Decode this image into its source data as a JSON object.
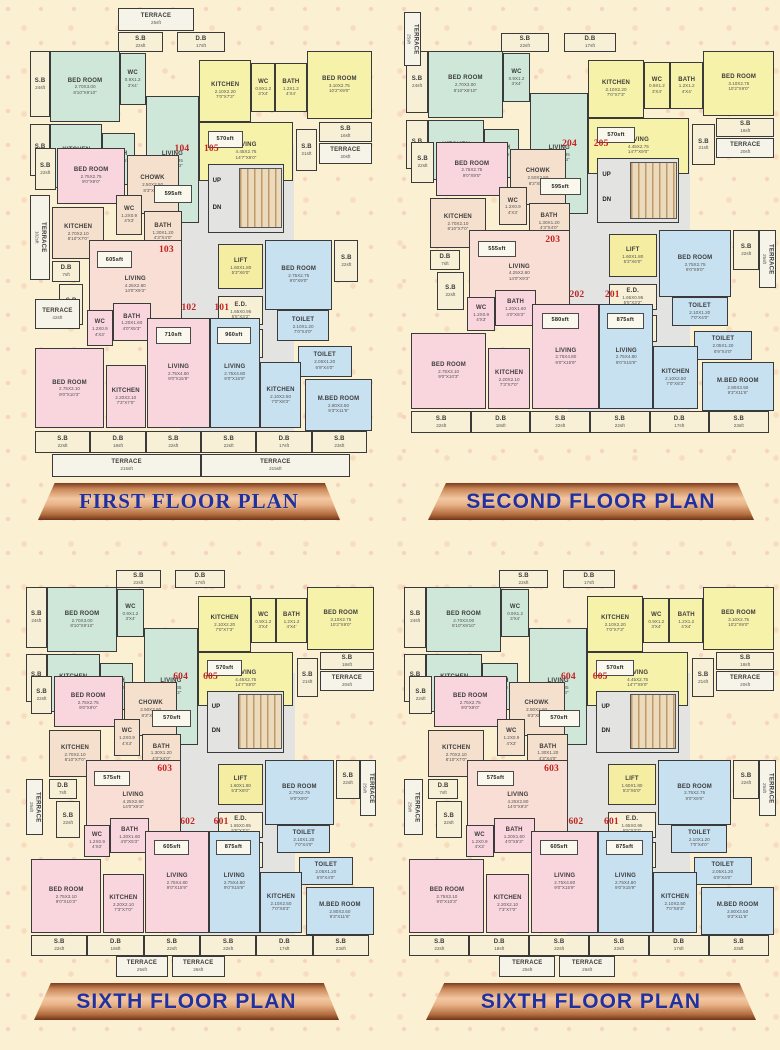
{
  "banners": [
    {
      "label": "FIRST FLOOR PLAN",
      "style": "serif"
    },
    {
      "label": "SECOND FLOOR PLAN",
      "style": "sans"
    },
    {
      "label": "SIXTH FLOOR PLAN",
      "style": "sans"
    },
    {
      "label": "SIXTH FLOOR PLAN",
      "style": "sans"
    }
  ],
  "colors": {
    "teal": "#cfe7d8",
    "yellow": "#f7f2a9",
    "pink": "#f9d6de",
    "peach": "#f5e0cd",
    "salmon": "#f8ded4",
    "blue": "#c8e1f1",
    "cream": "#f7f0d6",
    "white": "#f6f4e9",
    "lift": "#f5eea2",
    "lobby": "#e3e4e1"
  },
  "base_rooms": [
    {
      "id": "zone_lobby",
      "type": "zone",
      "color": "lobby",
      "rect": [
        44,
        29.5,
        33,
        60.5
      ],
      "lines": []
    },
    {
      "id": "terrace_top",
      "color": "white",
      "rect": [
        26,
        0.5,
        22,
        4.7
      ],
      "lines": [
        "TERRACE",
        "25sft"
      ]
    },
    {
      "id": "sb_top",
      "color": "cream",
      "rect": [
        26,
        5.5,
        13,
        4.3
      ],
      "lines": [
        "S.B",
        "22sft"
      ]
    },
    {
      "id": "db_top",
      "color": "cream",
      "rect": [
        43,
        5.5,
        14,
        4.3
      ],
      "lines": [
        "D.B",
        "17sft"
      ]
    },
    {
      "id": "sb_l1",
      "color": "cream",
      "rect": [
        0.5,
        9.5,
        6,
        14
      ],
      "lines": [
        "S.B",
        "24sft"
      ]
    },
    {
      "id": "bedroom_a",
      "color": "teal",
      "rect": [
        6.5,
        9.5,
        20,
        15
      ],
      "lines": [
        "BED ROOM",
        "2.70X3.00",
        "8'10\"X9'10\""
      ]
    },
    {
      "id": "wc_a",
      "color": "teal",
      "rect": [
        26.5,
        10,
        7.5,
        11
      ],
      "lines": [
        "WC",
        "0.9X1.2",
        "3'X4'"
      ]
    },
    {
      "id": "kitchen_a",
      "color": "teal",
      "rect": [
        6.5,
        25,
        15,
        13.5
      ],
      "lines": [
        "KITCHEN",
        "2.40X2.20",
        "8'0\"X7'3\""
      ]
    },
    {
      "id": "sb_l2",
      "color": "cream",
      "rect": [
        0.5,
        25,
        6,
        11
      ],
      "lines": [
        "S.B",
        "16sft"
      ]
    },
    {
      "id": "bath_a",
      "color": "teal",
      "rect": [
        21.5,
        27,
        9.5,
        11
      ],
      "lines": [
        "BATH",
        "1.2X1.2",
        "4'X4'"
      ]
    },
    {
      "id": "living_a",
      "color": "teal",
      "rect": [
        34,
        19,
        15.5,
        27
      ],
      "lines": [
        "LIVING",
        "2.75X4.35",
        "9'0\"X14'3\""
      ]
    },
    {
      "id": "area_a",
      "type": "area",
      "rect": [
        36.5,
        38,
        11,
        3.8
      ],
      "lines": []
    },
    {
      "id": "kitchen_b",
      "color": "yellow",
      "rect": [
        49.5,
        11.5,
        15,
        13
      ],
      "lines": [
        "KITCHEN",
        "2.10X2.20",
        "7'0\"X7'3\""
      ]
    },
    {
      "id": "wc_b",
      "color": "yellow",
      "rect": [
        64.5,
        12,
        7,
        10.5
      ],
      "lines": [
        "WC",
        "0.9X1.2",
        "3'X4'"
      ]
    },
    {
      "id": "bath_b",
      "color": "yellow",
      "rect": [
        71.5,
        12,
        9,
        10.5
      ],
      "lines": [
        "BATH",
        "1.2X1.2",
        "4'X4'"
      ]
    },
    {
      "id": "bedroom_b",
      "color": "yellow",
      "rect": [
        80.5,
        9.5,
        19,
        14.5
      ],
      "lines": [
        "BED ROOM",
        "3.10X2.75",
        "10'2\"X9'0\""
      ]
    },
    {
      "id": "living_b",
      "color": "yellow",
      "rect": [
        49.5,
        24.5,
        27,
        12.5
      ],
      "lines": [
        "LIVING",
        "4.45X2.75",
        "14'7\"X9'0\""
      ]
    },
    {
      "id": "area_b",
      "type": "area",
      "rect": [
        52,
        26.5,
        10,
        3.6
      ],
      "lines": []
    },
    {
      "id": "sb_r1",
      "color": "cream",
      "rect": [
        84,
        24.5,
        15.5,
        4.3
      ],
      "lines": [
        "S.B",
        "16sft"
      ]
    },
    {
      "id": "terrace_r1",
      "color": "white",
      "rect": [
        84,
        29,
        15.5,
        4.5
      ],
      "lines": [
        "TERRACE",
        "20sft"
      ]
    },
    {
      "id": "sb_r2",
      "color": "cream",
      "rect": [
        77.5,
        26,
        6,
        9
      ],
      "lines": [
        "S.B",
        "21sft"
      ]
    },
    {
      "id": "u_a",
      "type": "unit",
      "rect": [
        41,
        28.6,
        7,
        3.6
      ],
      "lines": []
    },
    {
      "id": "u_b",
      "type": "unit",
      "rect": [
        49.5,
        28.6,
        7,
        3.6
      ],
      "lines": []
    },
    {
      "id": "sb_l3",
      "color": "cream",
      "rect": [
        2,
        30,
        6,
        9
      ],
      "lines": [
        "S.B",
        "22sft"
      ]
    },
    {
      "id": "bedroom_c",
      "color": "pink",
      "rect": [
        8.5,
        30,
        19.5,
        12
      ],
      "lines": [
        "BED ROOM",
        "2.75X2.75",
        "9'0\"X9'0\""
      ]
    },
    {
      "id": "chowk",
      "color": "peach",
      "rect": [
        28.5,
        31.5,
        15,
        12.5
      ],
      "lines": [
        "CHOWK",
        "2.50X2.50",
        "8'3\"X8'3\""
      ]
    },
    {
      "id": "stairs",
      "type": "stairs",
      "color": "lobby",
      "rect": [
        52,
        33.5,
        22,
        14.5
      ],
      "labels": [
        "UP",
        "DN"
      ],
      "lines": []
    },
    {
      "id": "kitchen_c",
      "color": "peach",
      "rect": [
        7,
        42.5,
        15,
        11
      ],
      "lines": [
        "KITCHEN",
        "2.70X2.10",
        "8'10\"X7'0\""
      ]
    },
    {
      "id": "wc_c",
      "color": "peach",
      "rect": [
        25.5,
        40,
        7.5,
        8.5
      ],
      "lines": [
        "WC",
        "1.2X0.9",
        "4'X3'"
      ]
    },
    {
      "id": "bath_c",
      "color": "peach",
      "rect": [
        33.5,
        43.5,
        11,
        8.5
      ],
      "lines": [
        "BATH",
        "1.30X1.20",
        "4'3\"X4'0\""
      ]
    },
    {
      "id": "db_l",
      "color": "cream",
      "rect": [
        7,
        54,
        8,
        4.5
      ],
      "lines": [
        "D.B",
        "7sft"
      ]
    },
    {
      "id": "terrace_102",
      "color": "white",
      "vert": true,
      "rect": [
        0.5,
        40,
        6,
        18
      ],
      "lines": [
        "TERRACE",
        "102sft"
      ]
    },
    {
      "id": "sb_m",
      "color": "cream",
      "rect": [
        9,
        59,
        7,
        8.5
      ],
      "lines": [
        "S.B",
        "22sft"
      ]
    },
    {
      "id": "living_c",
      "color": "salmon",
      "rect": [
        17.5,
        49.5,
        27,
        19
      ],
      "lines": [
        "LIVING",
        "4.25X2.80",
        "14'0\"X9'3\""
      ]
    },
    {
      "id": "area_c",
      "type": "area",
      "rect": [
        20,
        52,
        10,
        3.6
      ],
      "lines": []
    },
    {
      "id": "u_c",
      "type": "unit",
      "rect": [
        36.5,
        50,
        7,
        3.6
      ],
      "lines": []
    },
    {
      "id": "lift",
      "color": "lift",
      "rect": [
        55,
        50.5,
        13,
        9.5
      ],
      "lines": [
        "LIFT",
        "1.60X1.80",
        "5'3\"X6'0\""
      ]
    },
    {
      "id": "ed",
      "color": "cream",
      "rect": [
        55,
        61.5,
        13,
        6
      ],
      "lines": [
        "E.D.",
        "1.65X0.95",
        "5'5\"X3'2\""
      ]
    },
    {
      "id": "fd",
      "color": "cream",
      "rect": [
        55,
        68.5,
        13,
        6
      ],
      "lines": [
        "F.D.",
        "1.65X1.00",
        "5'5\"X3'3\""
      ]
    },
    {
      "id": "bedroom_d",
      "color": "blue",
      "rect": [
        68.5,
        49.5,
        19.5,
        15
      ],
      "lines": [
        "BED ROOM",
        "2.75X2.75",
        "9'0\"X9'0\""
      ]
    },
    {
      "id": "sb_r3",
      "color": "cream",
      "rect": [
        88.5,
        49.5,
        7,
        9
      ],
      "lines": [
        "S.B",
        "22sft"
      ]
    },
    {
      "id": "toilet_1",
      "color": "blue",
      "rect": [
        72,
        64.5,
        15,
        6.5
      ],
      "lines": [
        "TOILET",
        "2.10X1.20",
        "7'0\"X4'0\""
      ]
    },
    {
      "id": "toilet_2",
      "color": "blue",
      "rect": [
        78,
        72,
        15.5,
        6.5
      ],
      "lines": [
        "TOILET",
        "2.05X1.20",
        "6'9\"X4'0\""
      ]
    },
    {
      "id": "terrace_42",
      "color": "white",
      "rect": [
        2,
        62,
        13,
        6.5
      ],
      "lines": [
        "TERRACE",
        "42sft"
      ]
    },
    {
      "id": "wc_d",
      "color": "pink",
      "rect": [
        17,
        64.5,
        7.5,
        7.5
      ],
      "lines": [
        "WC",
        "1.2X0.9",
        "4'X3'"
      ]
    },
    {
      "id": "bath_d",
      "color": "pink",
      "rect": [
        24.5,
        63,
        11,
        8
      ],
      "lines": [
        "BATH",
        "1.20X1.60",
        "4'0\"X5'3\""
      ]
    },
    {
      "id": "u_d",
      "type": "unit",
      "rect": [
        43,
        62.3,
        7,
        3.6
      ],
      "lines": []
    },
    {
      "id": "u_e",
      "type": "unit",
      "rect": [
        52.5,
        62.3,
        7,
        3.6
      ],
      "lines": []
    },
    {
      "id": "living_d",
      "color": "pink",
      "rect": [
        34.5,
        66,
        18,
        23.5
      ],
      "lines": [
        "LIVING",
        "2.75X4.80",
        "9'0\"X15'9\""
      ]
    },
    {
      "id": "area_d",
      "type": "area",
      "rect": [
        37,
        68,
        10,
        3.6
      ],
      "lines": []
    },
    {
      "id": "living_e",
      "color": "blue",
      "rect": [
        52.5,
        66,
        14.5,
        23.5
      ],
      "lines": [
        "LIVING",
        "2.75X4.80",
        "9'0\"X15'9\""
      ]
    },
    {
      "id": "area_e",
      "type": "area",
      "rect": [
        54.5,
        68,
        10,
        3.6
      ],
      "lines": []
    },
    {
      "id": "bedroom_e",
      "color": "pink",
      "rect": [
        2,
        72.5,
        20,
        17
      ],
      "lines": [
        "BED ROOM",
        "2.75X3.10",
        "9'0\"X10'3\""
      ]
    },
    {
      "id": "kitchen_d",
      "color": "pink",
      "rect": [
        22.5,
        76,
        11.5,
        13.5
      ],
      "lines": [
        "KITCHEN",
        "2.20X2.10",
        "7'3\"X7'0\""
      ]
    },
    {
      "id": "kitchen_e",
      "color": "blue",
      "rect": [
        67,
        75.5,
        12,
        14
      ],
      "lines": [
        "KITCHEN",
        "2.10X2.50",
        "7'0\"X8'3\""
      ]
    },
    {
      "id": "m_bedroom",
      "color": "blue",
      "rect": [
        80,
        79,
        19.5,
        11
      ],
      "lines": [
        "M.BED ROOM",
        "2.80X3.50",
        "9'3\"X11'6\""
      ]
    },
    {
      "id": "sb_b1",
      "color": "cream",
      "rect": [
        2,
        90,
        16,
        4.8
      ],
      "lines": [
        "S.B",
        "22sft"
      ]
    },
    {
      "id": "db_b1",
      "color": "cream",
      "rect": [
        18,
        90,
        16,
        4.8
      ],
      "lines": [
        "D.B",
        "18sft"
      ]
    },
    {
      "id": "sb_b2",
      "color": "cream",
      "rect": [
        34,
        90,
        16,
        4.8
      ],
      "lines": [
        "S.B",
        "22sft"
      ]
    },
    {
      "id": "sb_b3",
      "color": "cream",
      "rect": [
        50,
        90,
        16,
        4.8
      ],
      "lines": [
        "S.B",
        "22sft"
      ]
    },
    {
      "id": "db_b2",
      "color": "cream",
      "rect": [
        66,
        90,
        16,
        4.8
      ],
      "lines": [
        "D.B",
        "17sft"
      ]
    },
    {
      "id": "sb_b4",
      "color": "cream",
      "rect": [
        82,
        90,
        16,
        4.8
      ],
      "lines": [
        "S.B",
        "23sft"
      ]
    },
    {
      "id": "terrace_b1",
      "color": "white",
      "rect": [
        7,
        95,
        43,
        4.7
      ],
      "lines": [
        "TERRACE",
        "215sft"
      ]
    },
    {
      "id": "terrace_b2",
      "color": "white",
      "rect": [
        50,
        95,
        43,
        4.7
      ],
      "lines": [
        "TERRACE",
        "215sft"
      ]
    }
  ],
  "plans": [
    {
      "name": "first-floor-plan",
      "patch": {
        "u_a": [
          "104"
        ],
        "u_b": [
          "105"
        ],
        "u_c": [
          "103"
        ],
        "u_d": [
          "102"
        ],
        "u_e": [
          "101"
        ],
        "area_a": [
          "595sft"
        ],
        "area_b": [
          "570sft"
        ],
        "area_c": [
          "605sft"
        ],
        "area_d": [
          "710sft"
        ],
        "area_e": [
          "960sft"
        ]
      },
      "remove": [],
      "add": []
    },
    {
      "name": "second-floor-plan",
      "patch": {
        "u_a": [
          "204"
        ],
        "u_b": [
          "205"
        ],
        "u_c": [
          "203"
        ],
        "u_d": [
          "202"
        ],
        "u_e": [
          "201"
        ],
        "area_a": [
          "595sft"
        ],
        "area_b": [
          "570sft"
        ],
        "area_c": [
          "555sft"
        ],
        "area_d": [
          "580sft"
        ],
        "area_e": [
          "875sft"
        ]
      },
      "remove": [
        "terrace_top",
        "terrace_102",
        "terrace_42",
        "terrace_b1",
        "terrace_b2"
      ],
      "add": [
        {
          "id": "terrace_vtl",
          "color": "white",
          "vert": true,
          "rect": [
            0,
            1,
            4.5,
            12
          ],
          "lines": [
            "TERRACE",
            "25sft"
          ]
        },
        {
          "id": "terrace_vr",
          "color": "white",
          "vert": true,
          "rect": [
            95.5,
            49.5,
            4.5,
            13
          ],
          "lines": [
            "TERRACE",
            "25sft"
          ]
        }
      ]
    },
    {
      "name": "sixth-floor-plan-left",
      "patch": {
        "u_a": [
          "604"
        ],
        "u_b": [
          "605"
        ],
        "u_c": [
          "603"
        ],
        "u_d": [
          "602"
        ],
        "u_e": [
          "601"
        ],
        "area_a": [
          "570sft"
        ],
        "area_b": [
          "570sft"
        ],
        "area_c": [
          "575sft"
        ],
        "area_d": [
          "605sft"
        ],
        "area_e": [
          "875sft"
        ],
        "sb_r1": [
          "S.B",
          "18sft"
        ]
      },
      "remove": [
        "terrace_top",
        "terrace_102",
        "terrace_42",
        "terrace_b1",
        "terrace_b2"
      ],
      "add": [
        {
          "id": "terrace_vml",
          "color": "white",
          "vert": true,
          "rect": [
            0.5,
            54,
            5,
            13
          ],
          "lines": [
            "TERRACE",
            "25sft"
          ]
        },
        {
          "id": "terrace_vr",
          "color": "white",
          "vert": true,
          "rect": [
            95.5,
            49.5,
            4.5,
            13
          ],
          "lines": [
            "TERRACE",
            "25sft"
          ]
        },
        {
          "id": "terrace_s1",
          "color": "white",
          "rect": [
            26,
            95,
            15,
            4.7
          ],
          "lines": [
            "TERRACE",
            "25sft"
          ]
        },
        {
          "id": "terrace_s2",
          "color": "white",
          "rect": [
            42,
            95,
            15,
            4.7
          ],
          "lines": [
            "TERRACE",
            "26sft"
          ]
        }
      ]
    },
    {
      "name": "sixth-floor-plan-right",
      "patch": {
        "u_a": [
          "604"
        ],
        "u_b": [
          "605"
        ],
        "u_c": [
          "603"
        ],
        "u_d": [
          "602"
        ],
        "u_e": [
          "601"
        ],
        "area_a": [
          "570sft"
        ],
        "area_b": [
          "570sft"
        ],
        "area_c": [
          "575sft"
        ],
        "area_d": [
          "605sft"
        ],
        "area_e": [
          "875sft"
        ],
        "sb_r1": [
          "S.B",
          "18sft"
        ]
      },
      "remove": [
        "terrace_top",
        "terrace_102",
        "terrace_42",
        "terrace_b1",
        "terrace_b2"
      ],
      "add": [
        {
          "id": "terrace_vml",
          "color": "white",
          "vert": true,
          "rect": [
            0.5,
            54,
            5,
            13
          ],
          "lines": [
            "TERRACE",
            "25sft"
          ]
        },
        {
          "id": "terrace_vr",
          "color": "white",
          "vert": true,
          "rect": [
            95.5,
            49.5,
            4.5,
            13
          ],
          "lines": [
            "TERRACE",
            "25sft"
          ]
        },
        {
          "id": "terrace_s1",
          "color": "white",
          "rect": [
            26,
            95,
            15,
            4.7
          ],
          "lines": [
            "TERRACE",
            "25sft"
          ]
        },
        {
          "id": "terrace_s2",
          "color": "white",
          "rect": [
            42,
            95,
            15,
            4.7
          ],
          "lines": [
            "TERRACE",
            "26sft"
          ]
        }
      ]
    }
  ]
}
